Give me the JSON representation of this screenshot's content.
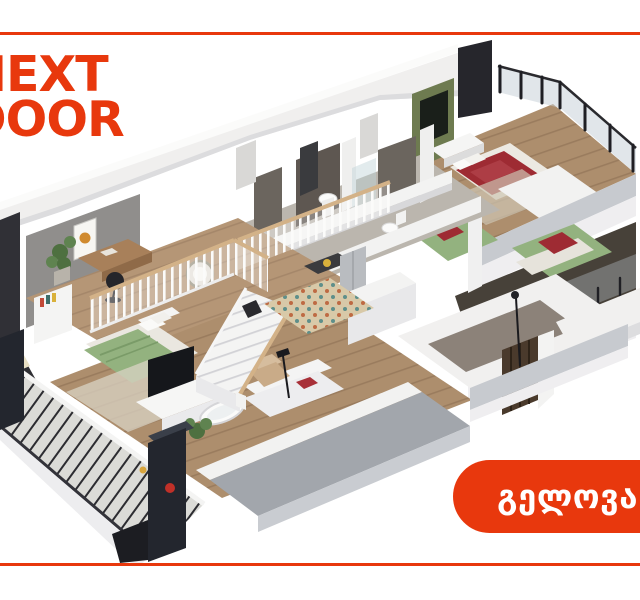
{
  "brand": {
    "name": "NEXT DOOR",
    "logo_line1": "NEXT",
    "logo_line2": "DOOR"
  },
  "badge": {
    "label": "გელოვანი"
  },
  "scene": {
    "name": "isometric-apartment-cutaway-render",
    "features": [
      "master-bedroom",
      "bedrooms",
      "bathrooms",
      "mezzanine-office",
      "staircase",
      "kitchen",
      "living-room",
      "balcony",
      "glass-balustrade"
    ]
  },
  "colors": {
    "brand_orange": "#E8380D",
    "page_bg": "#FFFFFF",
    "wall_white": "#F0EFEE",
    "wall_top": "#FBFBFA",
    "wall_shade": "#DCDCDE",
    "slab_gray": "#C7CACF",
    "terrace_gray": "#A2A6AC",
    "charcoal": "#26262C",
    "wood_floor": "#AD8E6D",
    "wood_plank_line": "#9A7C5E",
    "wood_mezzanine": "#B59676",
    "rail_cap_wood": "#D3B288",
    "accent_wall_green": "#6E7B50",
    "bed_green": "#93B27F",
    "bed_red": "#9E2B33",
    "glass_blue": "#C3CDD6",
    "deck_gray": "#DBDBD7",
    "tile_dark": "#5E5751",
    "mosaic_beige": "#D8C9A8",
    "interior_shadow": "#474139"
  }
}
